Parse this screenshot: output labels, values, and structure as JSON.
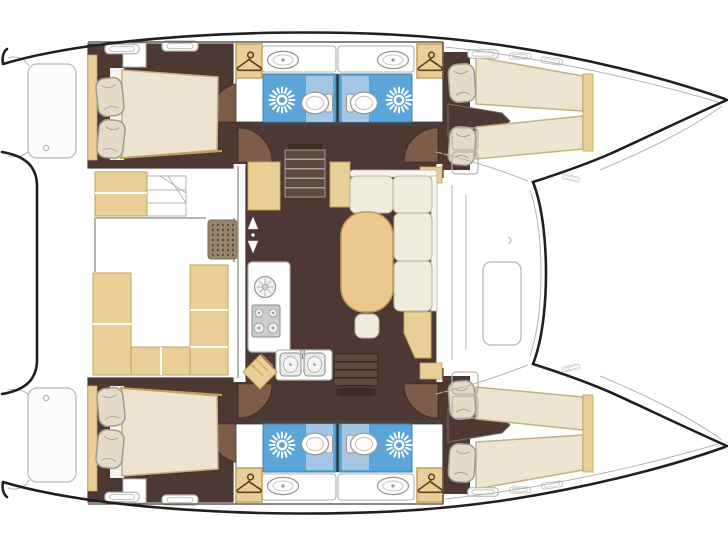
{
  "image": {
    "type": "floor-plan",
    "subject": "catamaran-yacht-deck-plan",
    "orientation": "bows-right-sterns-left",
    "text_labels": []
  },
  "inventory": {
    "cabins_double_bed": 2,
    "cabins_twin_tapered_beds": 2,
    "bathrooms": 4,
    "wardrobes_with_hanger_icon": 4,
    "shower_sun_icons": 4,
    "toilets": 4,
    "vanity_basins": 4,
    "galley": {
      "stove_burners": 4,
      "double_sink": true,
      "round_dial": true
    },
    "salon": {
      "l_settee": true,
      "oval_wood_table": true,
      "pouf": true
    },
    "cockpit": {
      "u_settee": true,
      "deck_grate": true,
      "stairs": true
    },
    "companionway_stairs": 2
  },
  "icons": [
    "shower-sun-icon",
    "hanger-icon",
    "toilet-icon",
    "sink-basin-icon",
    "stove-burners-icon",
    "companionway-arrows-icon",
    "deck-grate-icon",
    "deck-hatch-icon"
  ],
  "colors": {
    "hull": "#1f1f1f",
    "deck_line": "#b4b4b0",
    "deck_fill": "#fcfcfb",
    "wall_line": "#4a3a33",
    "floor": "#4d3833",
    "wall_band": "#474140",
    "door_swing": "#7d5c4a",
    "tan": "#e9cf97",
    "tan_border": "#c2a05a",
    "wood": "#ebc98e",
    "wood_border": "#c19a52",
    "mattress": "#ece4d0",
    "mattress_border": "#c3b083",
    "pillow": "#e3dbc8",
    "pillow_border": "#9c9c94",
    "sheet": "#f6f3ea",
    "settee": "#f0ebdf",
    "settee_border": "#b7b1a2",
    "bath_blue": "#5ba5d9",
    "bath_blue_border": "#3e7fae",
    "bath_blue_light": "#abcae5",
    "white_fixture": "#ffffff",
    "fixture_line": "#969696",
    "steel": "#c9cdc9",
    "steel_line": "#8a8f8a",
    "grate": "#97856f",
    "grate_dot": "#564939",
    "step_dark": "#3c2d26",
    "step_light": "#5f4a40",
    "hanger_line": "#5d4228"
  }
}
